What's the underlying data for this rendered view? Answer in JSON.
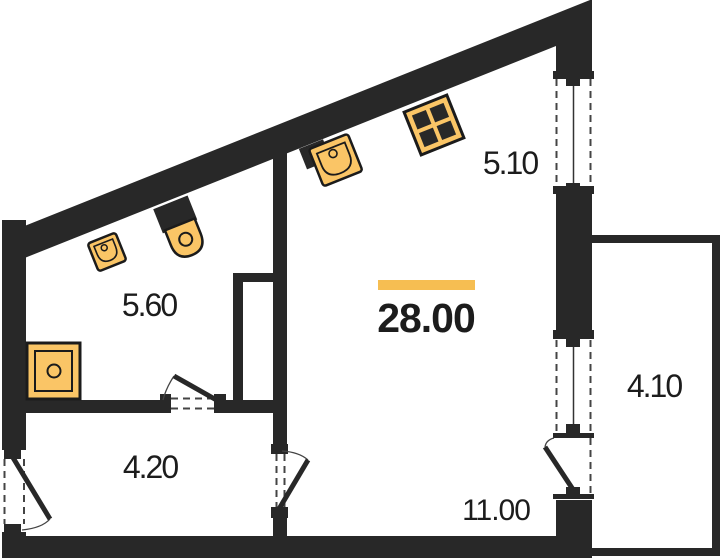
{
  "floorplan": {
    "unit_total_area": "28.00",
    "rooms": [
      {
        "name": "bathroom",
        "area": "5.60"
      },
      {
        "name": "kitchen-zone",
        "area": "5.10"
      },
      {
        "name": "studio-total",
        "area": "28.00",
        "highlighted": true
      },
      {
        "name": "balcony",
        "area": "4.10"
      },
      {
        "name": "hallway",
        "area": "4.20"
      },
      {
        "name": "living-zone",
        "area": "11.00"
      }
    ],
    "fixtures": [
      "bathroom-sink",
      "toilet",
      "shower",
      "kitchen-sink",
      "stove"
    ],
    "openings": [
      "entrance-door",
      "bathroom-door",
      "room-door",
      "balcony-door",
      "window-upper",
      "window-lower"
    ]
  },
  "colors": {
    "wall": "#282828",
    "fixture": "#FAC566",
    "accent": "#F6BE52",
    "text": "#1C1C1C",
    "line": "#1B1B1B",
    "dash": "#444444",
    "bg": "#FFFFFF"
  }
}
